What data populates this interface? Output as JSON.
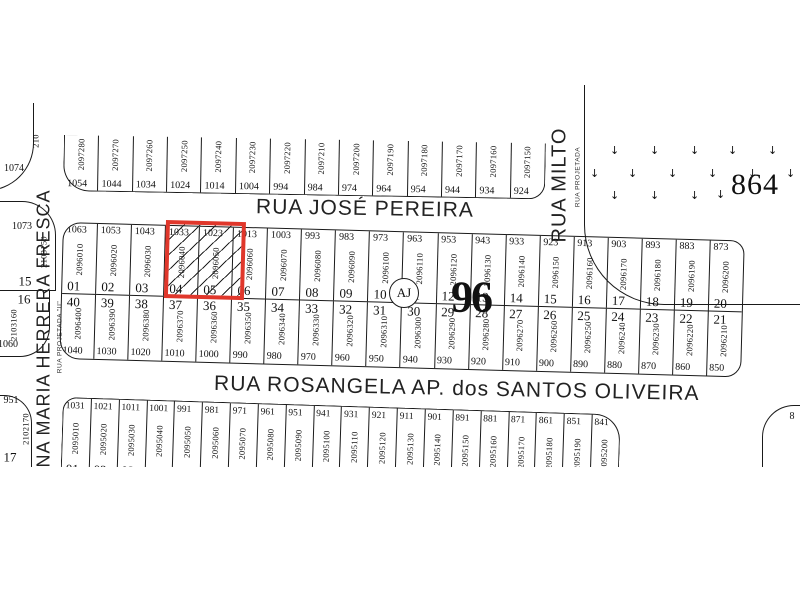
{
  "colors": {
    "background": "#ffffff",
    "line": "#1a1a1a",
    "highlight": "#e0372b"
  },
  "streets": {
    "jose_pereira": "RUA JOSÉ PEREIRA",
    "rosangela": "RUA ROSANGELA AP. dos SANTOS OLIVEIRA",
    "ana_maria": "ANA MARIA HERRERA FRESCA",
    "ana_maria_sub": "RUA PROJETADA \"II\"",
    "milton": "RUA MILTO",
    "milton_sub": "RUA PROJETADA"
  },
  "labels": {
    "block_number": "96",
    "aj_marker": "AJ",
    "area_number": "864",
    "right_edge_partial": "8"
  },
  "icons": {
    "vegetation_symbol": "↓"
  },
  "top_block": {
    "lots": [
      {
        "snum": "1054",
        "code": "2097280"
      },
      {
        "snum": "1044",
        "code": "2097270"
      },
      {
        "snum": "1034",
        "code": "2097260"
      },
      {
        "snum": "1024",
        "code": "2097250"
      },
      {
        "snum": "1014",
        "code": "2097240"
      },
      {
        "snum": "1004",
        "code": "2097230"
      },
      {
        "snum": "994",
        "code": "2097220"
      },
      {
        "snum": "984",
        "code": "2097210"
      },
      {
        "snum": "974",
        "code": "2097200"
      },
      {
        "snum": "964",
        "code": "2097190"
      },
      {
        "snum": "954",
        "code": "2097180"
      },
      {
        "snum": "944",
        "code": "2097170"
      },
      {
        "snum": "934",
        "code": "2097160"
      },
      {
        "snum": "924",
        "code": "2097150"
      }
    ]
  },
  "middle_block": {
    "upper_lots": [
      {
        "num": "01",
        "snum": "1063",
        "code": "2096010"
      },
      {
        "num": "02",
        "snum": "1053",
        "code": "2096020"
      },
      {
        "num": "03",
        "snum": "1043",
        "code": "2096030"
      },
      {
        "num": "04",
        "snum": "1033",
        "code": "2096040",
        "highlighted": true
      },
      {
        "num": "05",
        "snum": "1023",
        "code": "2096050",
        "highlighted": true
      },
      {
        "num": "06",
        "snum": "1013",
        "code": "2096060"
      },
      {
        "num": "07",
        "snum": "1003",
        "code": "2096070"
      },
      {
        "num": "08",
        "snum": "993",
        "code": "2096080"
      },
      {
        "num": "09",
        "snum": "983",
        "code": "2096090"
      },
      {
        "num": "10",
        "snum": "973",
        "code": "2096100"
      },
      {
        "num": "11",
        "snum": "963",
        "code": "2096110"
      },
      {
        "num": "12",
        "snum": "953",
        "code": "2096120"
      },
      {
        "num": "13",
        "snum": "943",
        "code": "2096130"
      },
      {
        "num": "14",
        "snum": "933",
        "code": "2096140"
      },
      {
        "num": "15",
        "snum": "923",
        "code": "2096150"
      },
      {
        "num": "16",
        "snum": "913",
        "code": "2096160"
      },
      {
        "num": "17",
        "snum": "903",
        "code": "2096170"
      },
      {
        "num": "18",
        "snum": "893",
        "code": "2096180"
      },
      {
        "num": "19",
        "snum": "883",
        "code": "2096190"
      },
      {
        "num": "20",
        "snum": "873",
        "code": "2096200"
      }
    ],
    "lower_lots": [
      {
        "num": "40",
        "snum": "1040",
        "code": "2096400"
      },
      {
        "num": "39",
        "snum": "1030",
        "code": "2096390"
      },
      {
        "num": "38",
        "snum": "1020",
        "code": "2096380"
      },
      {
        "num": "37",
        "snum": "1010",
        "code": "2096370"
      },
      {
        "num": "36",
        "snum": "1000",
        "code": "2096360"
      },
      {
        "num": "35",
        "snum": "990",
        "code": "2096350"
      },
      {
        "num": "34",
        "snum": "980",
        "code": "2096340"
      },
      {
        "num": "33",
        "snum": "970",
        "code": "2096330"
      },
      {
        "num": "32",
        "snum": "960",
        "code": "2096320"
      },
      {
        "num": "31",
        "snum": "950",
        "code": "2096310"
      },
      {
        "num": "30",
        "snum": "940",
        "code": "2096300"
      },
      {
        "num": "29",
        "snum": "930",
        "code": "2096290"
      },
      {
        "num": "28",
        "snum": "920",
        "code": "2096280"
      },
      {
        "num": "27",
        "snum": "910",
        "code": "2096270"
      },
      {
        "num": "26",
        "snum": "900",
        "code": "2096260"
      },
      {
        "num": "25",
        "snum": "890",
        "code": "2096250"
      },
      {
        "num": "24",
        "snum": "880",
        "code": "2096240"
      },
      {
        "num": "23",
        "snum": "870",
        "code": "2096230"
      },
      {
        "num": "22",
        "snum": "860",
        "code": "2096220"
      },
      {
        "num": "21",
        "snum": "850",
        "code": "2096210"
      }
    ]
  },
  "bottom_block": {
    "lots": [
      {
        "num": "01",
        "snum": "1031",
        "code": "2095010"
      },
      {
        "num": "02",
        "snum": "1021",
        "code": "2095020"
      },
      {
        "num": "03",
        "snum": "1011",
        "code": "2095030"
      },
      {
        "num": "04",
        "snum": "1001",
        "code": "2095040"
      },
      {
        "num": "05",
        "snum": "991",
        "code": "2095050"
      },
      {
        "num": "06",
        "snum": "981",
        "code": "2095060"
      },
      {
        "num": "07",
        "snum": "971",
        "code": "2095070"
      },
      {
        "num": "08",
        "snum": "961",
        "code": "2095080"
      },
      {
        "num": "09",
        "snum": "951",
        "code": "2095090"
      },
      {
        "num": "10",
        "snum": "941",
        "code": "2095100"
      },
      {
        "num": "11",
        "snum": "931",
        "code": "2095110"
      },
      {
        "num": "12",
        "snum": "921",
        "code": "2095120"
      },
      {
        "num": "13",
        "snum": "911",
        "code": "2095130"
      },
      {
        "num": "14",
        "snum": "901",
        "code": "2095140"
      },
      {
        "num": "15",
        "snum": "891",
        "code": "2095150"
      },
      {
        "num": "16",
        "snum": "881",
        "code": "2095160"
      },
      {
        "num": "17",
        "snum": "871",
        "code": "2095170"
      },
      {
        "num": "18",
        "snum": "861",
        "code": "2095180"
      },
      {
        "num": "19",
        "snum": "851",
        "code": "2095190"
      },
      {
        "num": "20",
        "snum": "841",
        "code": "2095200"
      }
    ]
  },
  "west_side": {
    "top_corner": {
      "code": "210",
      "snum": "1074"
    },
    "lot_a": {
      "num": "15",
      "snum": "1073",
      "code": "2103150"
    },
    "lot_b": {
      "num": "16",
      "snum": "1060",
      "code": "2103160"
    },
    "bottom_corner": {
      "num": "17",
      "snum": "951",
      "code": "2102170"
    }
  }
}
